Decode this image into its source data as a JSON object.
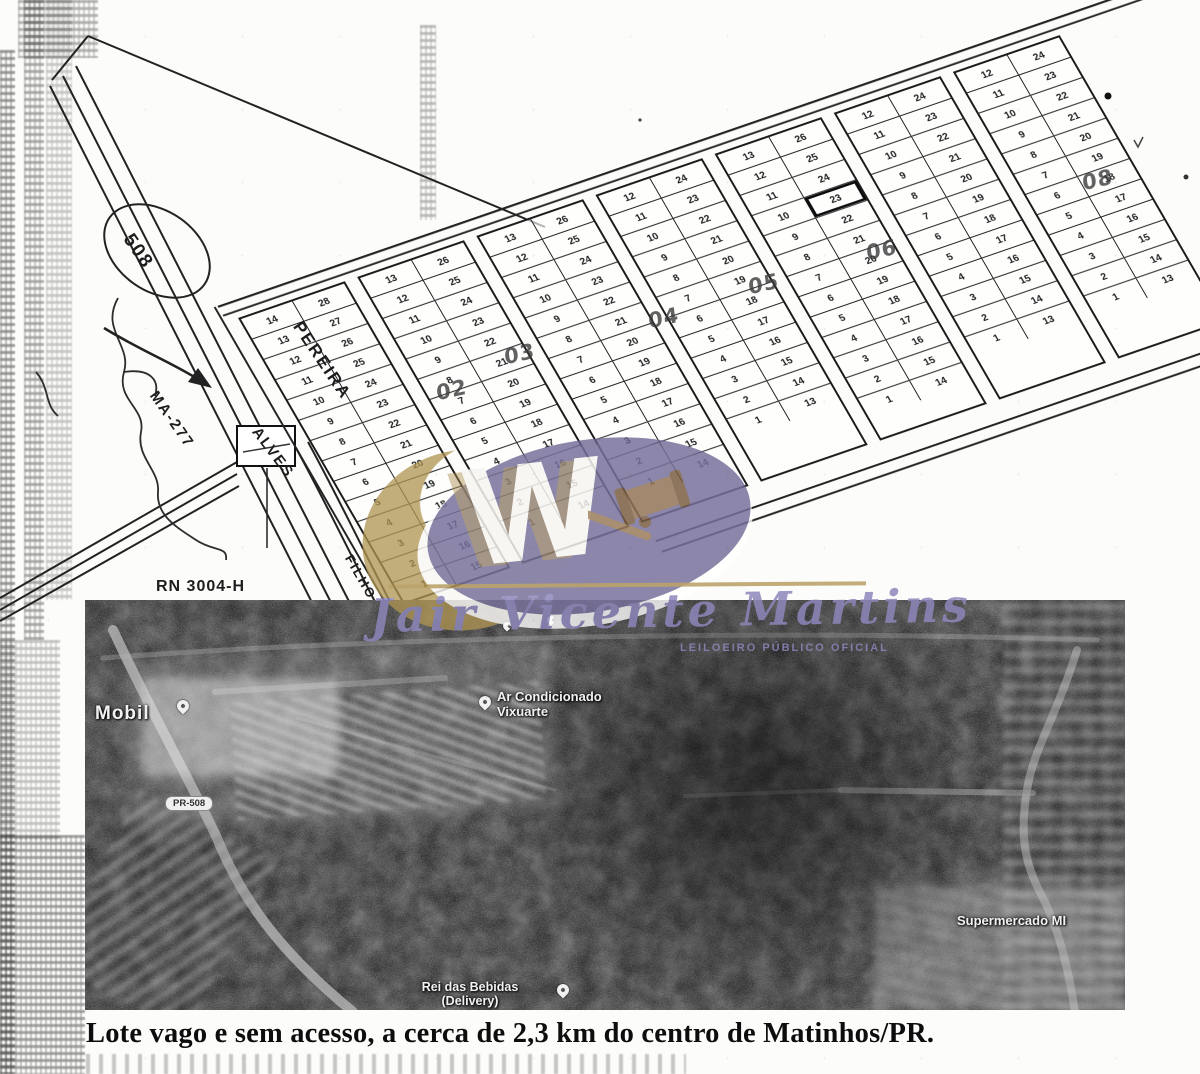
{
  "plat": {
    "circled_road_number": "508",
    "road_labels": {
      "pereira": "PEREIRA",
      "ma277": "MA-277",
      "alves": "ALVES",
      "filho": "FILHO"
    },
    "marker_label": "RN 3004-H",
    "quadra_labels": [
      "02",
      "03",
      "04",
      "05",
      "06",
      "08"
    ],
    "blocks": [
      {
        "left": [
          14,
          13,
          12,
          11,
          10,
          9,
          8,
          7,
          6,
          5,
          4,
          3,
          2,
          1
        ],
        "right": [
          28,
          27,
          26,
          25,
          24,
          23,
          22,
          21,
          20,
          19,
          18,
          17,
          16,
          15
        ]
      },
      {
        "left": [
          13,
          12,
          11,
          10,
          9,
          8,
          7,
          6,
          5,
          4,
          3,
          2,
          1
        ],
        "right": [
          26,
          25,
          24,
          23,
          22,
          21,
          20,
          19,
          18,
          17,
          16,
          15,
          14
        ]
      },
      {
        "left": [
          13,
          12,
          11,
          10,
          9,
          8,
          7,
          6,
          5,
          4,
          3,
          2,
          1
        ],
        "right": [
          26,
          25,
          24,
          23,
          22,
          21,
          20,
          19,
          18,
          17,
          16,
          15,
          14
        ]
      },
      {
        "left": [
          12,
          11,
          10,
          9,
          8,
          7,
          6,
          5,
          4,
          3,
          2,
          1
        ],
        "right": [
          24,
          23,
          22,
          21,
          20,
          19,
          18,
          17,
          16,
          15,
          14,
          13
        ]
      },
      {
        "left": [
          13,
          12,
          11,
          10,
          9,
          8,
          7,
          6,
          5,
          4,
          3,
          2,
          1
        ],
        "right": [
          26,
          25,
          24,
          23,
          22,
          21,
          20,
          19,
          18,
          17,
          16,
          15,
          14
        ]
      },
      {
        "left": [
          12,
          11,
          10,
          9,
          8,
          7,
          6,
          5,
          4,
          3,
          2,
          1
        ],
        "right": [
          24,
          23,
          22,
          21,
          20,
          19,
          18,
          17,
          16,
          15,
          14,
          13
        ]
      },
      {
        "left": [
          12,
          11,
          10,
          9,
          8,
          7,
          6,
          5,
          4,
          3,
          2,
          1
        ],
        "right": [
          24,
          23,
          22,
          21,
          20,
          19,
          18,
          17,
          16,
          15,
          14,
          13
        ]
      }
    ],
    "highlighted_lot": {
      "block": 4,
      "side": "right",
      "value": 23
    }
  },
  "watermark": {
    "monogram": "W",
    "auctioneer_name": "Jair Vicente Martins",
    "auctioneer_title": "LEILOEIRO PÚBLICO OFICIAL",
    "colors": {
      "gold": "#af9452",
      "purple": "#6c6694",
      "script": "#8d87bb"
    }
  },
  "satellite": {
    "labels": {
      "gas_station": "Mobil",
      "road_badge": "PR-508",
      "business_top_line1": "Ar Condicionado",
      "business_top_line2": "Vixuarte",
      "business_bottom_line1": "Rei das Bebidas",
      "business_bottom_line2": "(Delivery)",
      "supermarket": "Supermercado MI"
    }
  },
  "caption": {
    "text": "Lote vago e sem acesso, a cerca de 2,3 km do centro de Matinhos/PR."
  }
}
